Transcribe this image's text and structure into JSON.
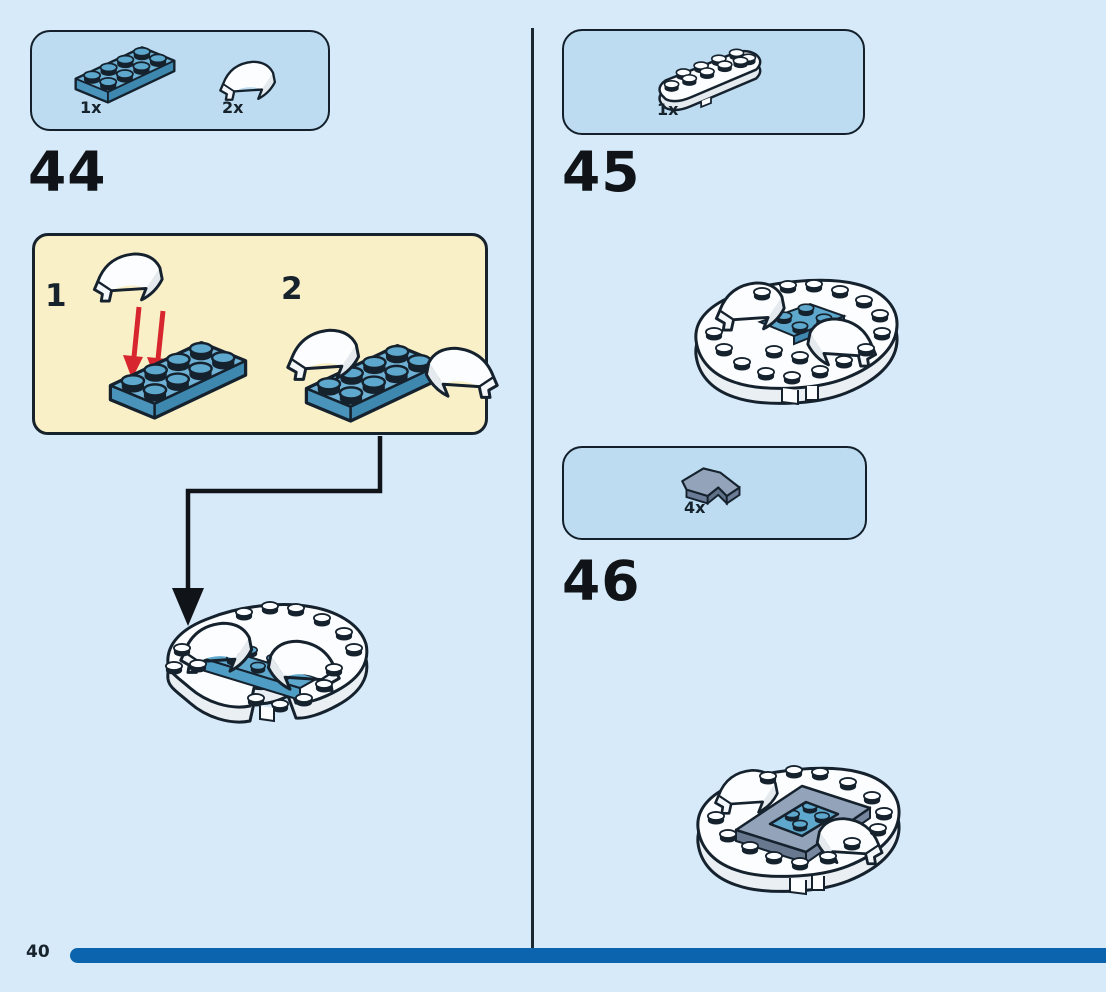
{
  "page": {
    "number": "40",
    "background_color": "#d7eaf9",
    "progress_bar_color": "#0b64ad",
    "outline_color": "#15222e"
  },
  "colors": {
    "parts_box_fill": "#bddcf1",
    "callout_fill": "#faf0c8",
    "brick_blue": "#5fa8cd",
    "brick_white": "#fbfdfe",
    "brick_sand_blue": "#93a3ba",
    "arrow_red": "#d8262e"
  },
  "steps": [
    {
      "id": "44",
      "parts": [
        {
          "icon": "blue-plate-2x4-icon",
          "count": "1x"
        },
        {
          "icon": "white-curved-slope-2x2-icon",
          "count": "2x"
        }
      ],
      "substeps": [
        {
          "label": "1"
        },
        {
          "label": "2"
        }
      ]
    },
    {
      "id": "45",
      "parts": [
        {
          "icon": "white-rounded-plate-2x6-icon",
          "count": "1x"
        }
      ]
    },
    {
      "id": "46",
      "parts": [
        {
          "icon": "sand-blue-corner-tile-icon",
          "count": "4x"
        }
      ]
    }
  ]
}
